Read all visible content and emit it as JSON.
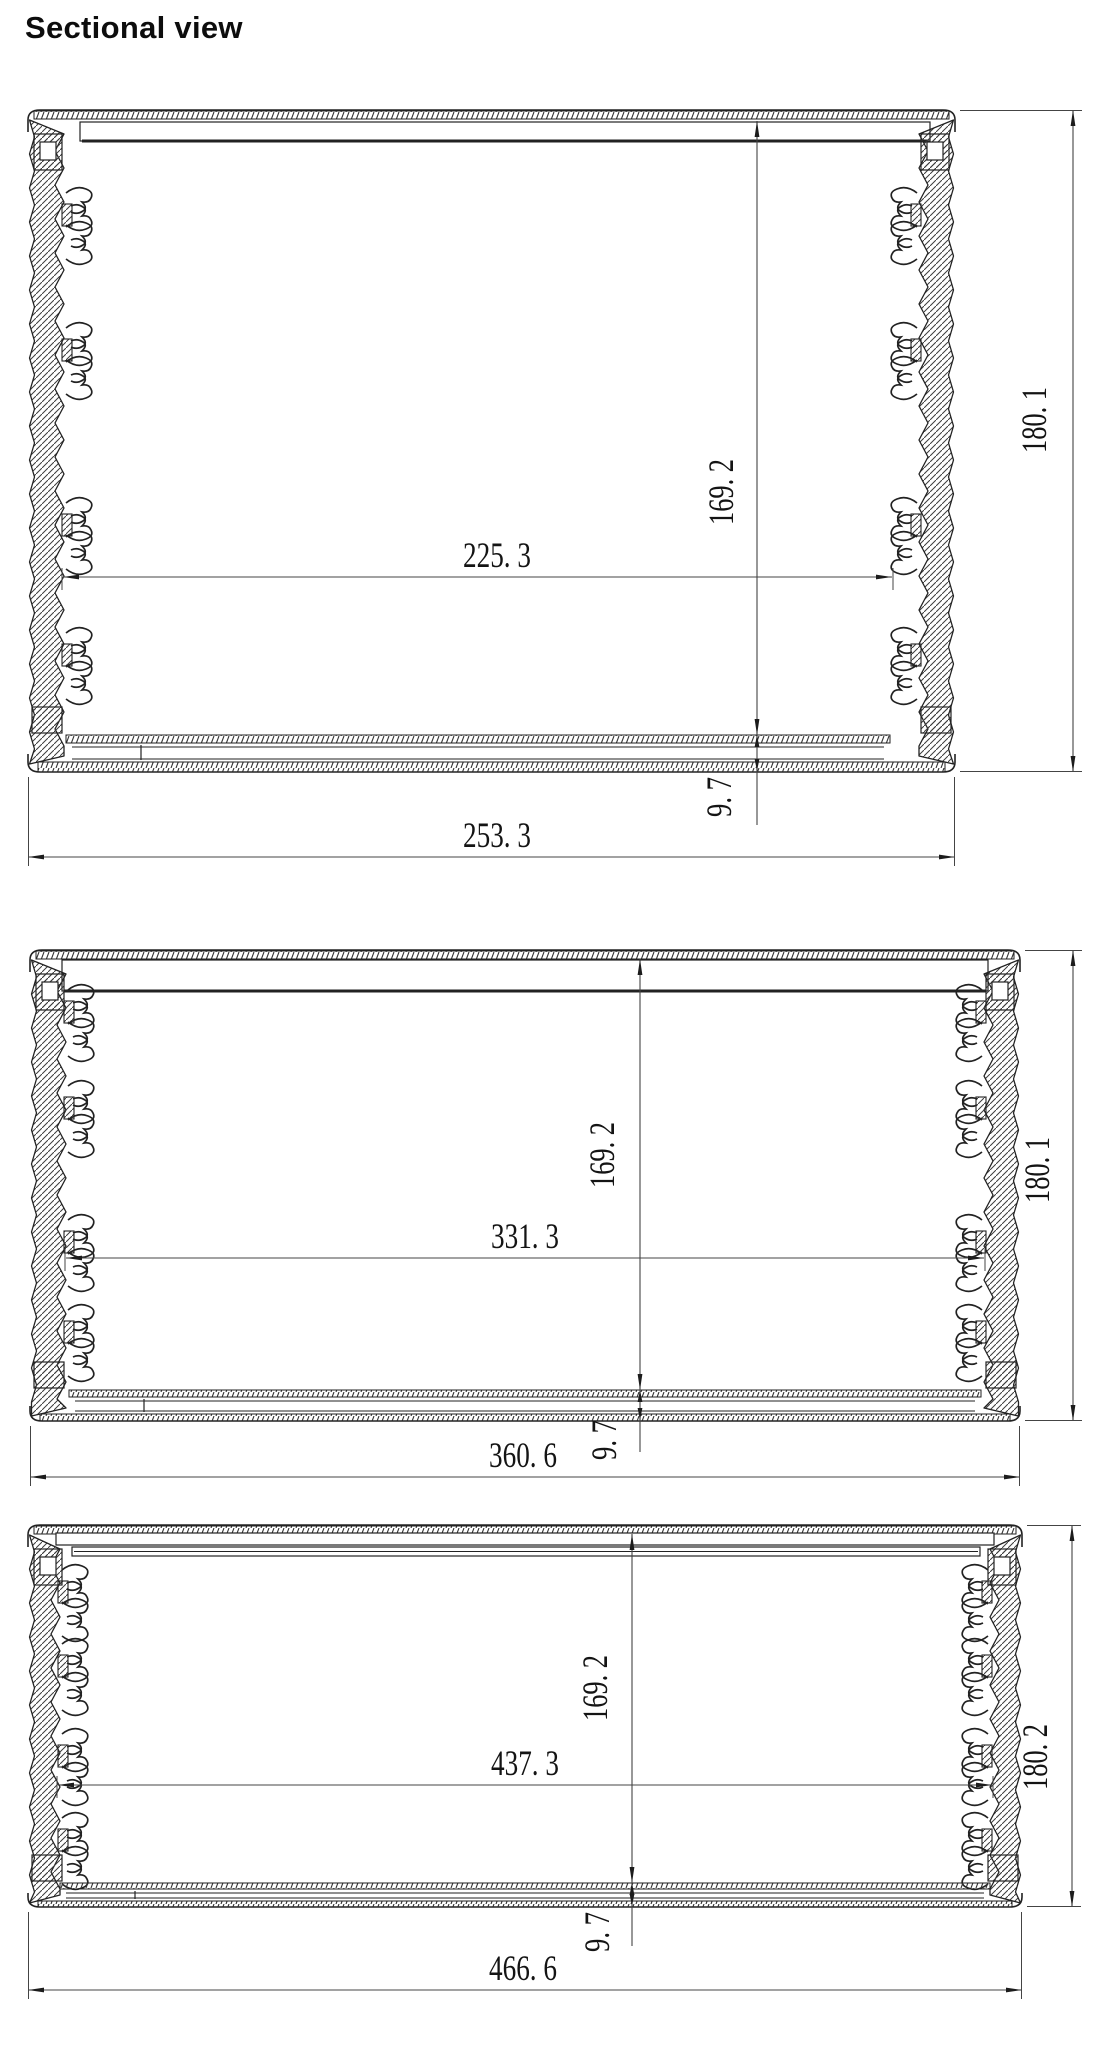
{
  "title": "Sectional view",
  "drawing_type": "aluminum enclosure extrusion cross-sections",
  "line_color": "#222222",
  "dim_color": "#444444",
  "views": [
    {
      "id": "section-small",
      "dimensions": {
        "inner_width": "225. 3",
        "inner_height": "169. 2",
        "base_thickness": "9. 7",
        "outer_width": "253. 3",
        "outer_height": "180. 1"
      }
    },
    {
      "id": "section-medium",
      "dimensions": {
        "inner_width": "331. 3",
        "inner_height": "169. 2",
        "base_thickness": "9. 7",
        "outer_width": "360. 6",
        "outer_height": "180. 1"
      }
    },
    {
      "id": "section-large",
      "dimensions": {
        "inner_width": "437. 3",
        "inner_height": "169. 2",
        "base_thickness": "9. 7",
        "outer_width": "466. 6",
        "outer_height": "180. 2"
      }
    }
  ]
}
